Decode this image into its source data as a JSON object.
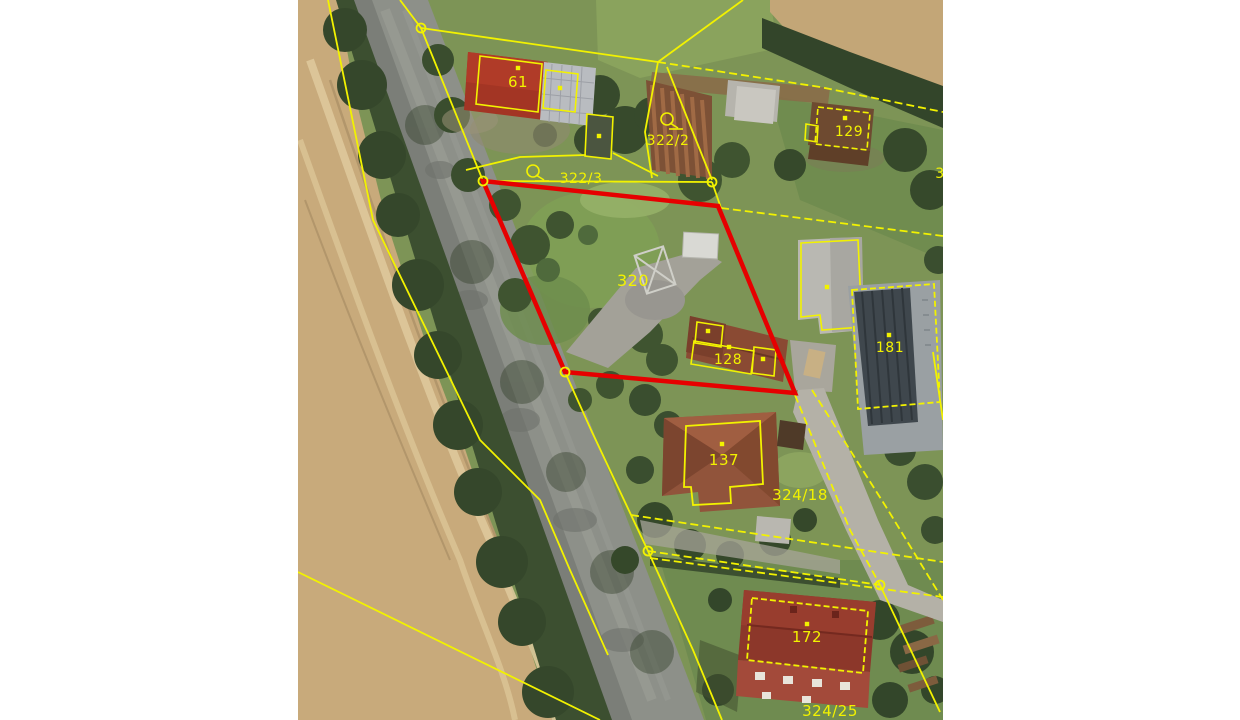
{
  "map": {
    "kind": "cadastral-aerial-view",
    "line_color": "#f2f200",
    "label_color": "#f2f200",
    "highlight_color": "#e60000",
    "parcel_labels": [
      {
        "text": "61",
        "x": 518,
        "y": 87,
        "size": 15
      },
      {
        "text": "322/2",
        "x": 668,
        "y": 145,
        "size": 14
      },
      {
        "text": "129",
        "x": 849,
        "y": 136,
        "size": 14
      },
      {
        "text": "322/3",
        "x": 581,
        "y": 183,
        "size": 14
      },
      {
        "text": "3",
        "x": 940,
        "y": 178,
        "size": 14
      },
      {
        "text": "320",
        "x": 633,
        "y": 286,
        "size": 16
      },
      {
        "text": "128",
        "x": 728,
        "y": 364,
        "size": 14
      },
      {
        "text": "181",
        "x": 890,
        "y": 352,
        "size": 14
      },
      {
        "text": "137",
        "x": 724,
        "y": 465,
        "size": 15
      },
      {
        "text": "324/18",
        "x": 800,
        "y": 500,
        "size": 15
      },
      {
        "text": "172",
        "x": 807,
        "y": 642,
        "size": 15
      },
      {
        "text": "324/25",
        "x": 830,
        "y": 716,
        "size": 15
      }
    ],
    "land_use_symbols": [
      {
        "x": 533,
        "y": 171
      },
      {
        "x": 667,
        "y": 119
      }
    ],
    "vertex_markers": [
      [
        421,
        28
      ],
      [
        483,
        181
      ],
      [
        712,
        182
      ],
      [
        565,
        372
      ],
      [
        648,
        551
      ],
      [
        880,
        585
      ]
    ],
    "building_dots": [
      [
        518,
        68
      ],
      [
        560,
        88
      ],
      [
        599,
        136
      ],
      [
        845,
        118
      ],
      [
        708,
        331
      ],
      [
        729,
        347
      ],
      [
        763,
        359
      ],
      [
        827,
        287
      ],
      [
        889,
        335
      ],
      [
        722,
        444
      ],
      [
        807,
        624
      ]
    ],
    "highlighted_parcel": {
      "label": "320",
      "vertices": [
        [
          483,
          181
        ],
        [
          718,
          206
        ],
        [
          795,
          393
        ],
        [
          565,
          372
        ]
      ]
    }
  }
}
